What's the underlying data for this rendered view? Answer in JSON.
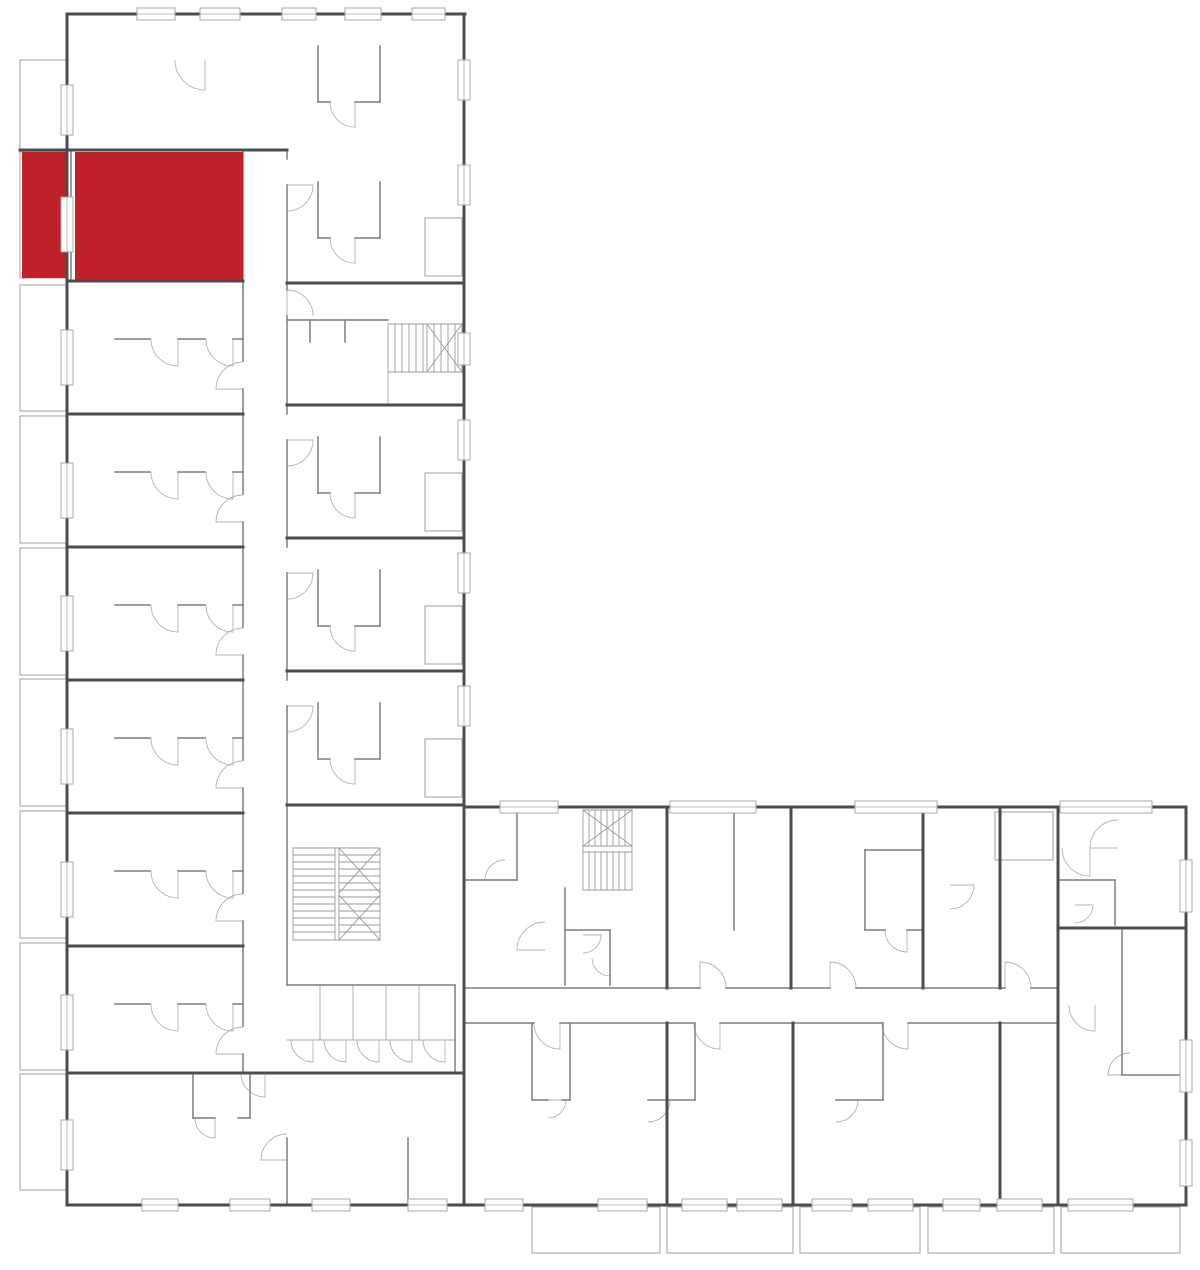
{
  "meta": {
    "canvas": {
      "w": 1200,
      "h": 1270
    },
    "description": "floor-plan-with-highlighted-unit"
  },
  "colors": {
    "background": "#ffffff",
    "wall_strong": "#4c4c4c",
    "wall_medium": "#7d7d7d",
    "wall_light": "#a8a8a8",
    "door": "#b4b4b4",
    "window_fill": "#ffffff",
    "highlight": "#be2127"
  },
  "highlight_unit": {
    "name": "selected-apartment",
    "rects": [
      [
        22,
        152,
        45,
        126
      ],
      [
        75,
        152,
        168,
        129
      ]
    ]
  },
  "walls_strong": [
    [
      20,
      150,
      287,
      150
    ],
    [
      67,
      14,
      465,
      14
    ],
    [
      67,
      14,
      67,
      1205
    ],
    [
      464,
      14,
      464,
      1205
    ],
    [
      464,
      807,
      1186,
      807
    ],
    [
      1186,
      807,
      1186,
      1205
    ],
    [
      67,
      1205,
      1186,
      1205
    ],
    [
      67,
      281,
      243,
      281
    ],
    [
      67,
      414,
      243,
      414
    ],
    [
      67,
      547,
      243,
      547
    ],
    [
      67,
      680,
      243,
      680
    ],
    [
      67,
      813,
      243,
      813
    ],
    [
      67,
      946,
      243,
      946
    ],
    [
      67,
      1073,
      464,
      1073
    ],
    [
      287,
      283,
      464,
      283
    ],
    [
      287,
      405,
      464,
      405
    ],
    [
      287,
      538,
      464,
      538
    ],
    [
      287,
      671,
      464,
      671
    ],
    [
      287,
      805,
      464,
      805
    ],
    [
      667,
      807,
      667,
      988
    ],
    [
      791,
      807,
      791,
      988
    ],
    [
      923,
      807,
      923,
      988
    ],
    [
      1000,
      807,
      1000,
      988
    ],
    [
      1058,
      807,
      1058,
      928
    ],
    [
      1058,
      928,
      1186,
      928
    ],
    [
      1058,
      928,
      1058,
      1205
    ],
    [
      667,
      1023,
      667,
      1205
    ],
    [
      793,
      1023,
      793,
      1205
    ],
    [
      1000,
      1023,
      1000,
      1205
    ]
  ],
  "walls_medium": [
    [
      243,
      150,
      243,
      361
    ],
    [
      243,
      389,
      243,
      494
    ],
    [
      243,
      522,
      243,
      627
    ],
    [
      243,
      655,
      243,
      760
    ],
    [
      243,
      788,
      243,
      893
    ],
    [
      243,
      921,
      243,
      1026
    ],
    [
      243,
      1054,
      243,
      1073
    ],
    [
      287,
      150,
      287,
      159
    ],
    [
      287,
      185,
      287,
      290
    ],
    [
      287,
      316,
      287,
      414
    ],
    [
      287,
      440,
      287,
      547
    ],
    [
      287,
      573,
      287,
      680
    ],
    [
      287,
      706,
      287,
      985
    ],
    [
      464,
      988,
      700,
      988
    ],
    [
      726,
      988,
      830,
      988
    ],
    [
      856,
      988,
      1005,
      988
    ],
    [
      1031,
      988,
      1058,
      988
    ],
    [
      464,
      1023,
      534,
      1023
    ],
    [
      560,
      1023,
      694,
      1023
    ],
    [
      720,
      1023,
      882,
      1023
    ],
    [
      908,
      1023,
      1058,
      1023
    ],
    [
      865,
      850,
      865,
      930
    ],
    [
      865,
      850,
      923,
      850
    ],
    [
      865,
      930,
      885,
      930
    ],
    [
      907,
      930,
      923,
      930
    ],
    [
      115,
      339,
      150,
      339
    ],
    [
      178,
      339,
      205,
      339
    ],
    [
      233,
      339,
      243,
      339
    ],
    [
      115,
      472,
      150,
      472
    ],
    [
      178,
      472,
      205,
      472
    ],
    [
      233,
      472,
      243,
      472
    ],
    [
      115,
      605,
      150,
      605
    ],
    [
      178,
      605,
      205,
      605
    ],
    [
      233,
      605,
      243,
      605
    ],
    [
      115,
      738,
      150,
      738
    ],
    [
      178,
      738,
      205,
      738
    ],
    [
      233,
      738,
      243,
      738
    ],
    [
      115,
      871,
      150,
      871
    ],
    [
      178,
      871,
      205,
      871
    ],
    [
      233,
      871,
      243,
      871
    ],
    [
      115,
      1004,
      150,
      1004
    ],
    [
      178,
      1004,
      205,
      1004
    ],
    [
      233,
      1004,
      243,
      1004
    ],
    [
      318,
      46,
      318,
      102
    ],
    [
      380,
      46,
      380,
      102
    ],
    [
      318,
      102,
      330,
      102
    ],
    [
      355,
      102,
      380,
      102
    ],
    [
      318,
      182,
      318,
      238
    ],
    [
      380,
      182,
      380,
      238
    ],
    [
      318,
      238,
      330,
      238
    ],
    [
      355,
      238,
      380,
      238
    ],
    [
      318,
      437,
      318,
      493
    ],
    [
      380,
      437,
      380,
      493
    ],
    [
      318,
      493,
      330,
      493
    ],
    [
      355,
      493,
      380,
      493
    ],
    [
      318,
      570,
      318,
      626
    ],
    [
      380,
      570,
      380,
      626
    ],
    [
      318,
      626,
      330,
      626
    ],
    [
      355,
      626,
      380,
      626
    ],
    [
      318,
      703,
      318,
      759
    ],
    [
      380,
      703,
      380,
      759
    ],
    [
      318,
      759,
      330,
      759
    ],
    [
      355,
      759,
      380,
      759
    ],
    [
      287,
      320,
      388,
      320
    ],
    [
      310,
      320,
      310,
      342
    ],
    [
      345,
      320,
      345,
      342
    ],
    [
      287,
      985,
      455,
      985
    ],
    [
      455,
      985,
      455,
      1073
    ],
    [
      193,
      1073,
      193,
      1118
    ],
    [
      250,
      1073,
      250,
      1118
    ],
    [
      193,
      1118,
      215,
      1118
    ],
    [
      238,
      1118,
      250,
      1118
    ],
    [
      287,
      1138,
      287,
      1205
    ],
    [
      408,
      1138,
      408,
      1205
    ],
    [
      565,
      888,
      565,
      985
    ],
    [
      565,
      930,
      610,
      930
    ],
    [
      610,
      930,
      610,
      985
    ],
    [
      517,
      807,
      517,
      880
    ],
    [
      464,
      880,
      517,
      880
    ],
    [
      734,
      807,
      734,
      930
    ],
    [
      1060,
      880,
      1115,
      880
    ],
    [
      1115,
      880,
      1115,
      925
    ],
    [
      1122,
      928,
      1122,
      1075
    ],
    [
      1122,
      1075,
      1186,
      1075
    ],
    [
      532,
      1023,
      532,
      1100
    ],
    [
      570,
      1023,
      570,
      1100
    ],
    [
      532,
      1100,
      548,
      1100
    ],
    [
      562,
      1100,
      570,
      1100
    ],
    [
      695,
      1023,
      695,
      1100
    ],
    [
      648,
      1100,
      695,
      1100
    ],
    [
      883,
      1023,
      883,
      1100
    ],
    [
      836,
      1100,
      883,
      1100
    ],
    [
      71,
      152,
      71,
      281
    ]
  ],
  "walls_light": [
    [
      320,
      985,
      320,
      1040
    ],
    [
      353,
      985,
      353,
      1040
    ],
    [
      386,
      985,
      386,
      1040
    ],
    [
      419,
      985,
      419,
      1040
    ],
    [
      287,
      1040,
      455,
      1040
    ],
    [
      388,
      372,
      388,
      405
    ]
  ],
  "stairs_lines": [
    [
      388,
      324,
      462,
      324
    ],
    [
      462,
      324,
      462,
      372
    ],
    [
      388,
      372,
      462,
      372
    ],
    [
      388,
      324,
      388,
      372
    ],
    [
      395,
      324,
      395,
      372
    ],
    [
      402,
      324,
      402,
      372
    ],
    [
      409,
      324,
      409,
      372
    ],
    [
      416,
      324,
      416,
      372
    ],
    [
      423,
      324,
      423,
      372
    ],
    [
      427,
      324,
      427,
      372
    ],
    [
      434,
      324,
      434,
      372
    ],
    [
      441,
      324,
      441,
      372
    ],
    [
      448,
      324,
      448,
      372
    ],
    [
      455,
      324,
      455,
      372
    ],
    [
      427,
      324,
      462,
      372
    ],
    [
      427,
      372,
      462,
      324
    ],
    [
      293,
      848,
      380,
      848
    ],
    [
      380,
      848,
      380,
      940
    ],
    [
      293,
      940,
      380,
      940
    ],
    [
      293,
      848,
      293,
      940
    ],
    [
      335,
      848,
      335,
      940
    ],
    [
      339,
      848,
      339,
      940
    ],
    [
      293,
      855,
      335,
      855
    ],
    [
      293,
      862,
      335,
      862
    ],
    [
      293,
      869,
      335,
      869
    ],
    [
      293,
      876,
      335,
      876
    ],
    [
      293,
      883,
      335,
      883
    ],
    [
      293,
      890,
      335,
      890
    ],
    [
      293,
      897,
      335,
      897
    ],
    [
      293,
      904,
      335,
      904
    ],
    [
      293,
      911,
      335,
      911
    ],
    [
      293,
      918,
      335,
      918
    ],
    [
      293,
      925,
      335,
      925
    ],
    [
      293,
      932,
      335,
      932
    ],
    [
      339,
      855,
      380,
      855
    ],
    [
      339,
      862,
      380,
      862
    ],
    [
      339,
      869,
      380,
      869
    ],
    [
      339,
      876,
      380,
      876
    ],
    [
      339,
      883,
      380,
      883
    ],
    [
      339,
      890,
      380,
      890
    ],
    [
      339,
      897,
      380,
      897
    ],
    [
      339,
      904,
      380,
      904
    ],
    [
      339,
      911,
      380,
      911
    ],
    [
      339,
      918,
      380,
      918
    ],
    [
      339,
      925,
      380,
      925
    ],
    [
      339,
      932,
      380,
      932
    ],
    [
      339,
      848,
      380,
      893
    ],
    [
      380,
      848,
      339,
      893
    ],
    [
      339,
      895,
      380,
      940
    ],
    [
      380,
      895,
      339,
      940
    ],
    [
      583,
      810,
      632,
      810
    ],
    [
      632,
      810,
      632,
      890
    ],
    [
      583,
      890,
      632,
      890
    ],
    [
      583,
      810,
      583,
      890
    ],
    [
      583,
      846,
      632,
      846
    ],
    [
      583,
      852,
      632,
      852
    ],
    [
      589,
      810,
      589,
      846
    ],
    [
      595,
      810,
      595,
      846
    ],
    [
      601,
      810,
      601,
      846
    ],
    [
      607,
      810,
      607,
      846
    ],
    [
      613,
      810,
      613,
      846
    ],
    [
      619,
      810,
      619,
      846
    ],
    [
      625,
      810,
      625,
      846
    ],
    [
      589,
      852,
      589,
      890
    ],
    [
      595,
      852,
      595,
      890
    ],
    [
      601,
      852,
      601,
      890
    ],
    [
      607,
      852,
      607,
      890
    ],
    [
      613,
      852,
      613,
      890
    ],
    [
      619,
      852,
      619,
      890
    ],
    [
      625,
      852,
      625,
      890
    ],
    [
      583,
      810,
      632,
      846
    ],
    [
      583,
      846,
      632,
      810
    ]
  ],
  "balconies": [
    [
      20,
      60,
      47,
      90
    ],
    [
      20,
      152,
      47,
      126
    ],
    [
      20,
      285,
      47,
      126
    ],
    [
      20,
      416,
      47,
      127
    ],
    [
      20,
      548,
      47,
      127
    ],
    [
      20,
      679,
      47,
      127
    ],
    [
      20,
      811,
      47,
      127
    ],
    [
      20,
      943,
      47,
      127
    ],
    [
      20,
      1074,
      47,
      116
    ],
    [
      532,
      1207,
      128,
      46
    ],
    [
      667,
      1207,
      126,
      46
    ],
    [
      800,
      1207,
      120,
      46
    ],
    [
      928,
      1207,
      126,
      46
    ],
    [
      1061,
      1207,
      119,
      46
    ],
    [
      425,
      218,
      37,
      58
    ],
    [
      425,
      473,
      37,
      58
    ],
    [
      425,
      606,
      37,
      58
    ],
    [
      425,
      739,
      37,
      58
    ],
    [
      995,
      812,
      58,
      48
    ]
  ],
  "windows": [
    [
      137,
      8,
      38,
      12
    ],
    [
      200,
      8,
      40,
      12
    ],
    [
      282,
      8,
      34,
      12
    ],
    [
      345,
      8,
      36,
      12
    ],
    [
      412,
      8,
      33,
      12
    ],
    [
      500,
      801,
      58,
      12
    ],
    [
      670,
      801,
      86,
      12
    ],
    [
      855,
      801,
      82,
      12
    ],
    [
      1060,
      801,
      92,
      12
    ],
    [
      142,
      1199,
      36,
      12
    ],
    [
      230,
      1199,
      40,
      12
    ],
    [
      312,
      1199,
      38,
      12
    ],
    [
      408,
      1199,
      39,
      12
    ],
    [
      485,
      1199,
      38,
      12
    ],
    [
      598,
      1199,
      49,
      12
    ],
    [
      682,
      1199,
      45,
      12
    ],
    [
      737,
      1199,
      45,
      12
    ],
    [
      812,
      1199,
      40,
      12
    ],
    [
      868,
      1199,
      45,
      12
    ],
    [
      943,
      1199,
      37,
      12
    ],
    [
      997,
      1199,
      45,
      12
    ],
    [
      1068,
      1199,
      65,
      12
    ],
    [
      61,
      85,
      12,
      50
    ],
    [
      61,
      197,
      12,
      55
    ],
    [
      61,
      330,
      12,
      55
    ],
    [
      61,
      463,
      12,
      55
    ],
    [
      61,
      596,
      12,
      55
    ],
    [
      61,
      729,
      12,
      55
    ],
    [
      61,
      862,
      12,
      55
    ],
    [
      61,
      995,
      12,
      55
    ],
    [
      61,
      1120,
      12,
      50
    ],
    [
      458,
      60,
      12,
      40
    ],
    [
      458,
      165,
      12,
      40
    ],
    [
      458,
      333,
      12,
      32
    ],
    [
      458,
      420,
      12,
      40
    ],
    [
      458,
      553,
      12,
      40
    ],
    [
      458,
      686,
      12,
      40
    ],
    [
      1180,
      860,
      12,
      52
    ],
    [
      1180,
      1040,
      12,
      52
    ],
    [
      1180,
      1140,
      12,
      46
    ]
  ],
  "doors": [
    [
      178,
      339,
      27,
      90
    ],
    [
      233,
      339,
      27,
      90
    ],
    [
      243,
      389,
      27,
      180
    ],
    [
      178,
      472,
      27,
      90
    ],
    [
      233,
      472,
      27,
      90
    ],
    [
      243,
      522,
      27,
      180
    ],
    [
      178,
      605,
      27,
      90
    ],
    [
      233,
      605,
      27,
      90
    ],
    [
      243,
      655,
      27,
      180
    ],
    [
      178,
      738,
      27,
      90
    ],
    [
      233,
      738,
      27,
      90
    ],
    [
      243,
      788,
      27,
      180
    ],
    [
      178,
      871,
      27,
      90
    ],
    [
      233,
      871,
      27,
      90
    ],
    [
      243,
      921,
      27,
      180
    ],
    [
      178,
      1004,
      27,
      90
    ],
    [
      233,
      1004,
      27,
      90
    ],
    [
      243,
      1054,
      27,
      180
    ],
    [
      355,
      102,
      25,
      90
    ],
    [
      205,
      60,
      30,
      90
    ],
    [
      287,
      185,
      26,
      0
    ],
    [
      355,
      238,
      25,
      90
    ],
    [
      287,
      440,
      26,
      0
    ],
    [
      355,
      493,
      25,
      90
    ],
    [
      287,
      573,
      26,
      0
    ],
    [
      355,
      626,
      25,
      90
    ],
    [
      287,
      706,
      26,
      0
    ],
    [
      355,
      759,
      25,
      90
    ],
    [
      287,
      316,
      26,
      270
    ],
    [
      313,
      1040,
      22,
      90
    ],
    [
      346,
      1040,
      22,
      90
    ],
    [
      379,
      1040,
      22,
      90
    ],
    [
      412,
      1040,
      22,
      90
    ],
    [
      445,
      1040,
      22,
      90
    ],
    [
      215,
      1118,
      20,
      90
    ],
    [
      287,
      1160,
      26,
      180
    ],
    [
      265,
      1073,
      24,
      90
    ],
    [
      700,
      988,
      26,
      270
    ],
    [
      830,
      988,
      26,
      270
    ],
    [
      1005,
      988,
      26,
      270
    ],
    [
      907,
      930,
      22,
      90
    ],
    [
      950,
      885,
      24,
      0
    ],
    [
      545,
      950,
      28,
      180
    ],
    [
      583,
      935,
      18,
      0
    ],
    [
      610,
      958,
      18,
      90
    ],
    [
      505,
      880,
      20,
      180
    ],
    [
      1090,
      848,
      28,
      90
    ],
    [
      1118,
      848,
      28,
      180
    ],
    [
      1075,
      905,
      18,
      0
    ],
    [
      1095,
      1005,
      26,
      90
    ],
    [
      1130,
      1075,
      22,
      180
    ],
    [
      560,
      1023,
      26,
      90
    ],
    [
      720,
      1023,
      26,
      90
    ],
    [
      908,
      1023,
      26,
      90
    ],
    [
      548,
      1100,
      18,
      0
    ],
    [
      648,
      1100,
      22,
      0
    ],
    [
      836,
      1100,
      22,
      0
    ]
  ]
}
